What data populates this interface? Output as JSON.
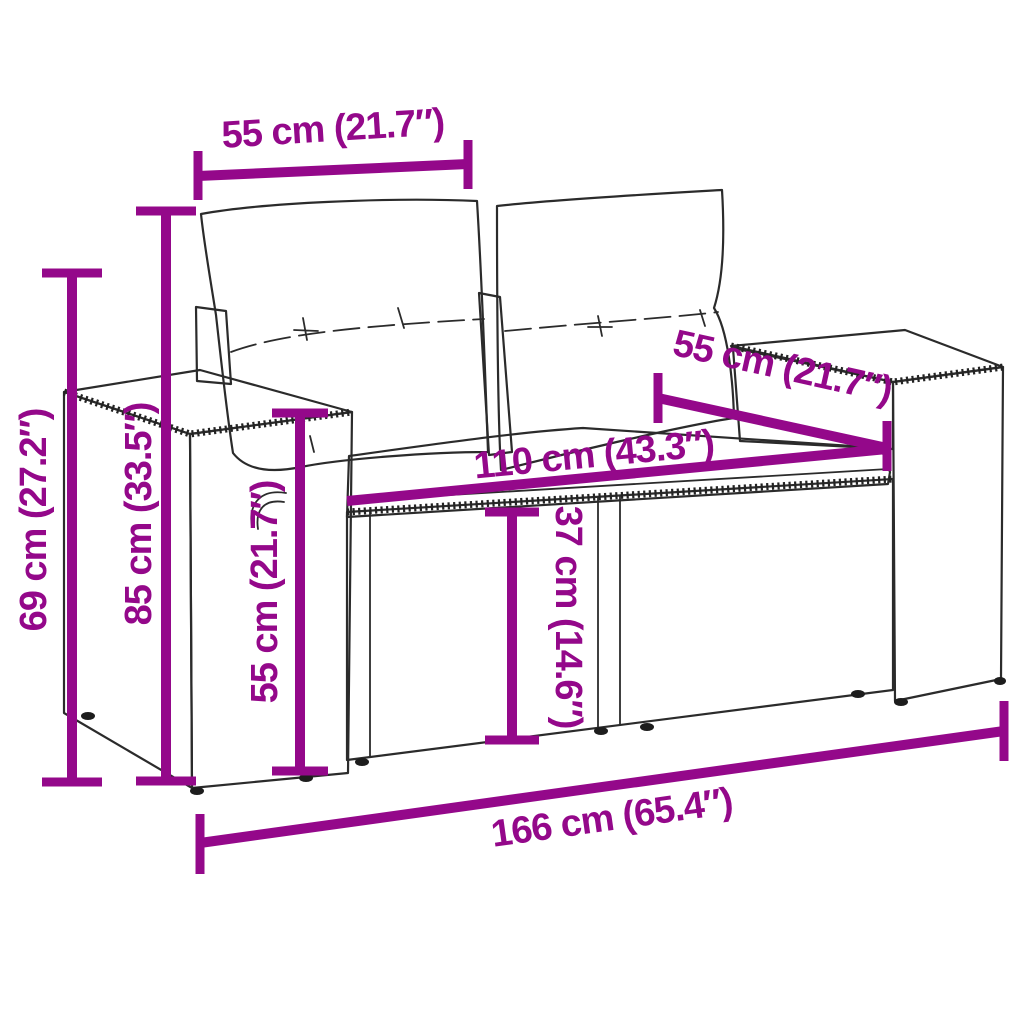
{
  "figure": {
    "subject": "wicker-loveseat-line-art",
    "style": "dimension-diagram"
  },
  "colors": {
    "dimension_accent": "#94088A",
    "line_art": "#2b2b2b",
    "background": "#ffffff"
  },
  "dims": [
    {
      "id": "back-cushion-width",
      "text": "55 cm (21.7″)"
    },
    {
      "id": "seat-depth",
      "text": "55 cm (21.7″)"
    },
    {
      "id": "seat-width",
      "text": "110 cm (43.3″)"
    },
    {
      "id": "armrest-height",
      "text": "69 cm (27.2″)"
    },
    {
      "id": "back-height",
      "text": "85 cm (33.5″)"
    },
    {
      "id": "seat-front-height",
      "text": "55 cm (21.7″)"
    },
    {
      "id": "seat-height",
      "text": "37 cm (14.6″)"
    },
    {
      "id": "total-width",
      "text": "166 cm (65.4″)"
    }
  ]
}
